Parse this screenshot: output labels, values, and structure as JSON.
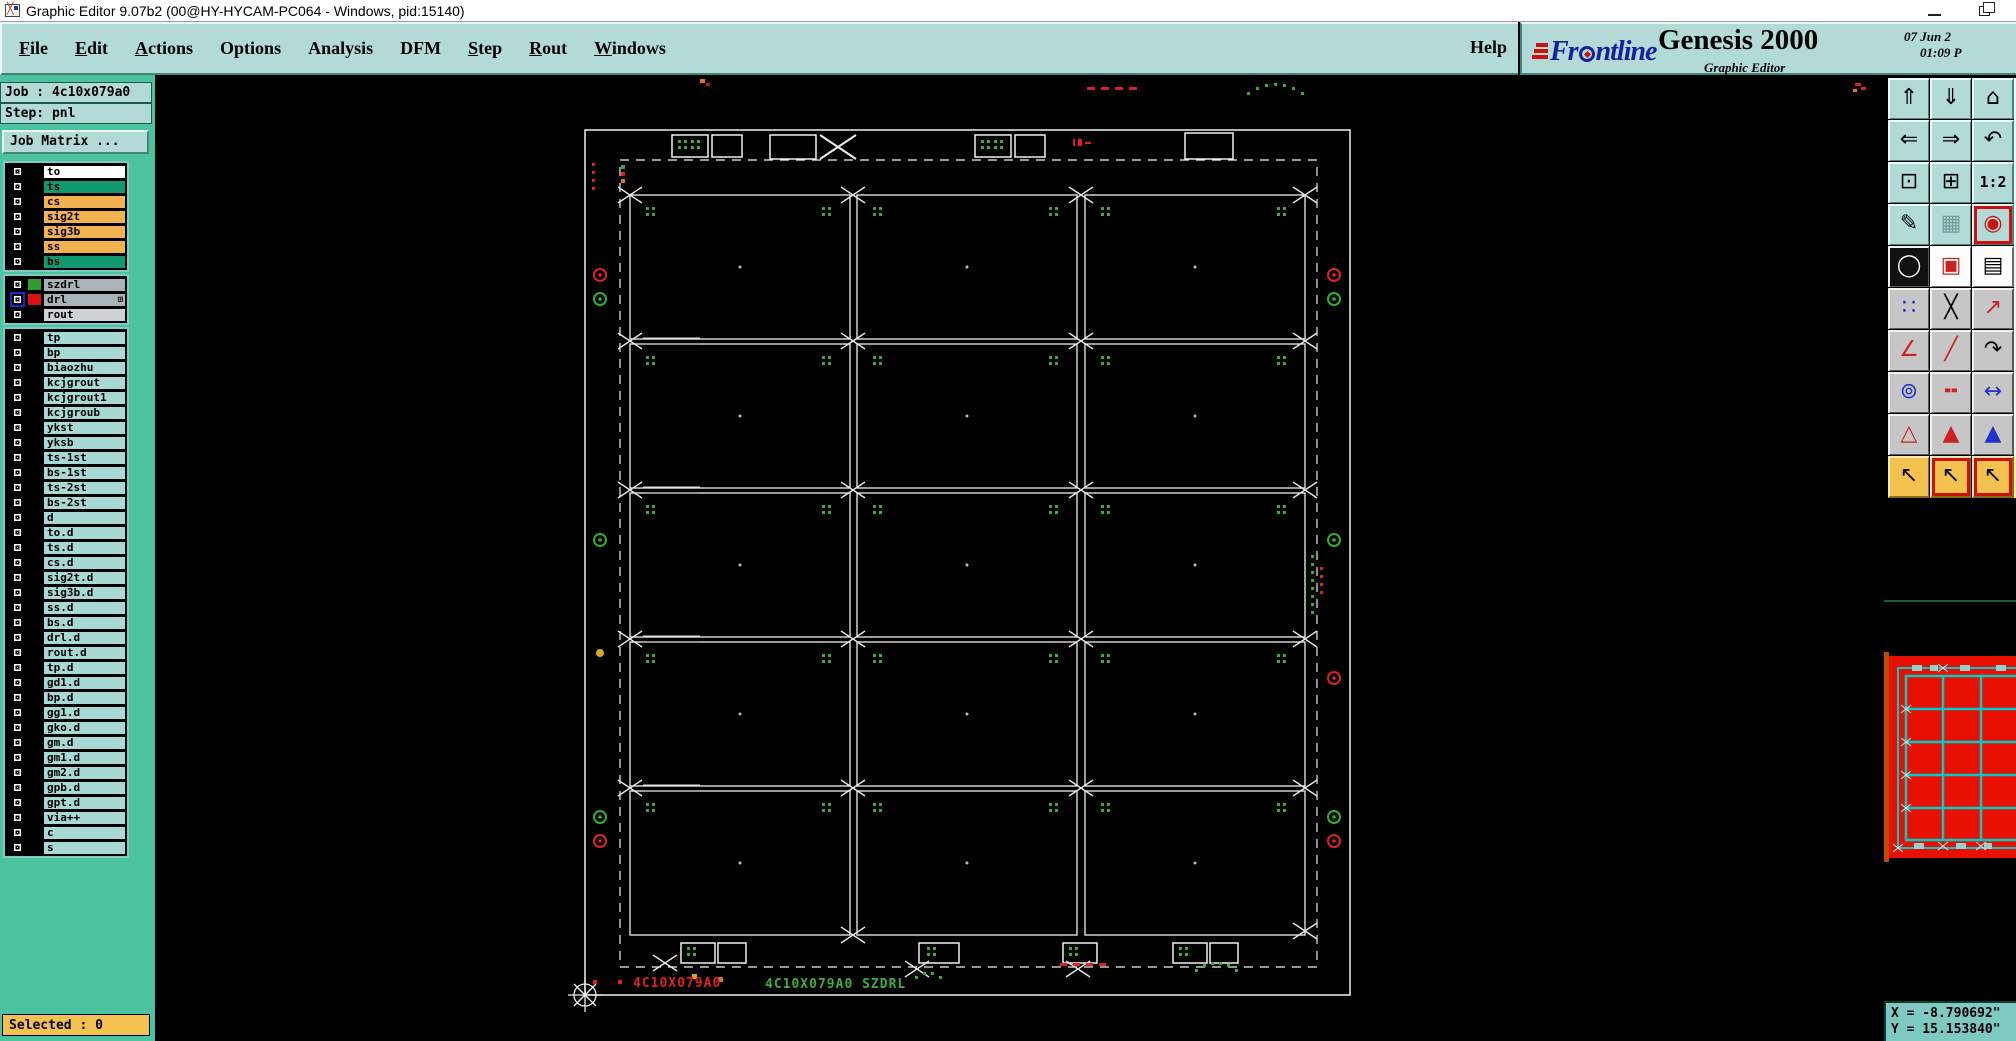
{
  "window": {
    "title": "Graphic Editor 9.07b2 (00@HY-HYCAM-PC064 - Windows, pid:15140)"
  },
  "menu": {
    "items": [
      {
        "name": "menu-file",
        "head": "F",
        "tail": "ile",
        "u": "u"
      },
      {
        "name": "menu-edit",
        "head": "E",
        "tail": "dit",
        "u": "u"
      },
      {
        "name": "menu-actions",
        "head": "A",
        "tail": "ctions",
        "u": "u"
      },
      {
        "name": "menu-options",
        "head": "O",
        "tail": "ptions"
      },
      {
        "name": "menu-analysis",
        "head": "A",
        "tail": "nalysis"
      },
      {
        "name": "menu-dfm",
        "head": "D",
        "tail": "FM"
      },
      {
        "name": "menu-step",
        "head": "S",
        "tail": "tep",
        "u": "u"
      },
      {
        "name": "menu-rout",
        "head": "R",
        "tail": "out",
        "u": "u"
      },
      {
        "name": "menu-windows",
        "head": "W",
        "tail": "indows",
        "u": "u"
      }
    ],
    "help_label": "Help"
  },
  "brand": {
    "company_prefix": "Fr",
    "company_suffix": "ntline",
    "product": "Genesis 2000",
    "app_subtitle": "Graphic Editor",
    "date": "07 Jun 2",
    "time": "01:09 P"
  },
  "sidebar": {
    "job_label": "Job : 4c10x079a0",
    "step_label": "Step: pnl",
    "matrix_button": "Job Matrix ...",
    "selected_label": "Selected : 0",
    "group1": [
      {
        "label": "to",
        "bg": "#ffffff"
      },
      {
        "label": "ts",
        "bg": "#12996f"
      },
      {
        "label": "cs",
        "bg": "#f2b24e"
      },
      {
        "label": "sig2t",
        "bg": "#f2b24e"
      },
      {
        "label": "sig3b",
        "bg": "#f2b24e"
      },
      {
        "label": "ss",
        "bg": "#f2b24e"
      },
      {
        "label": "bs",
        "bg": "#12996f"
      }
    ],
    "group2": [
      {
        "label": "szdrl",
        "bg": "#a9b4ba",
        "chip": "#2f9e2f"
      },
      {
        "label": "drl",
        "bg": "#a9b4ba",
        "chip": "#dd1111",
        "cls": "active",
        "suffix": "⊞"
      },
      {
        "label": "rout",
        "bg": "#ced2d5"
      }
    ],
    "group3": [
      {
        "label": "tp"
      },
      {
        "label": "bp"
      },
      {
        "label": "biaozhu"
      },
      {
        "label": "kcjgrout"
      },
      {
        "label": "kcjgrout1"
      },
      {
        "label": "kcjgroub"
      },
      {
        "label": "ykst"
      },
      {
        "label": "yksb"
      },
      {
        "label": "ts-1st"
      },
      {
        "label": "bs-1st"
      },
      {
        "label": "ts-2st"
      },
      {
        "label": "bs-2st"
      },
      {
        "label": "d"
      },
      {
        "label": "to.d"
      },
      {
        "label": "ts.d"
      },
      {
        "label": "cs.d"
      },
      {
        "label": "sig2t.d"
      },
      {
        "label": "sig3b.d"
      },
      {
        "label": "ss.d"
      },
      {
        "label": "bs.d"
      },
      {
        "label": "drl.d"
      },
      {
        "label": "rout.d"
      },
      {
        "label": "tp.d"
      },
      {
        "label": "gd1.d"
      },
      {
        "label": "bp.d"
      },
      {
        "label": "gg1.d"
      },
      {
        "label": "gko.d"
      },
      {
        "label": "gm.d"
      },
      {
        "label": "gm1.d"
      },
      {
        "label": "gm2.d"
      },
      {
        "label": "gpb.d"
      },
      {
        "label": "gpt.d"
      },
      {
        "label": "via++"
      },
      {
        "label": "c"
      },
      {
        "label": "s"
      }
    ]
  },
  "toolbar": {
    "buttons": [
      {
        "name": "view-up-button",
        "glyph": "⇑",
        "cls": "teal"
      },
      {
        "name": "view-down-button",
        "glyph": "⇓",
        "cls": "teal"
      },
      {
        "name": "home-view-button",
        "glyph": "⌂",
        "cls": "teal"
      },
      {
        "name": "view-left-button",
        "glyph": "⇐",
        "cls": "teal"
      },
      {
        "name": "view-right-button",
        "glyph": "⇒",
        "cls": "teal"
      },
      {
        "name": "previous-view-button",
        "glyph": "↶",
        "cls": "teal"
      },
      {
        "name": "zoom-fit-button",
        "glyph": "⊡",
        "cls": "teal"
      },
      {
        "name": "zoom-center-button",
        "glyph": "⊞",
        "cls": "teal"
      },
      {
        "name": "zoom-1-2-button",
        "glyph": "1:2",
        "cls": "teal txt"
      },
      {
        "name": "setup-editor-button",
        "glyph": "✎",
        "cls": "teal"
      },
      {
        "name": "grid-settings-button",
        "glyph": "▦",
        "cls": "teal",
        "fg": "#6f9e9a"
      },
      {
        "name": "targets-button",
        "glyph": "◉",
        "cls": "teal redframe",
        "fg": "#cc1111"
      },
      {
        "name": "layer-display-button",
        "glyph": "◯",
        "cls": "blackface",
        "fg": "#ffffff"
      },
      {
        "name": "shape-editor-button",
        "glyph": "▣",
        "cls": "whiteface",
        "fg": "#cc2222"
      },
      {
        "name": "measure-ruler-button",
        "glyph": "▤",
        "cls": "whiteface"
      },
      {
        "name": "net-highlight-button",
        "glyph": "∷",
        "cls": "gray",
        "fg": "#2233cc"
      },
      {
        "name": "unselect-button",
        "glyph": "╳",
        "cls": "gray"
      },
      {
        "name": "point-snap-button",
        "glyph": "↗",
        "cls": "gray",
        "fg": "#cc2222"
      },
      {
        "name": "angle-measure-button",
        "glyph": "∠",
        "cls": "gray",
        "fg": "#cc2222"
      },
      {
        "name": "distance-measure-button",
        "glyph": "╱",
        "cls": "gray",
        "fg": "#cc2222"
      },
      {
        "name": "rotate-view-button",
        "glyph": "↷",
        "cls": "gray"
      },
      {
        "name": "pad-copy-button",
        "glyph": "⊚",
        "cls": "gray",
        "fg": "#2233cc"
      },
      {
        "name": "line-width-button",
        "glyph": "╍",
        "cls": "gray",
        "fg": "#cc2222"
      },
      {
        "name": "width-measure-button",
        "glyph": "↔",
        "cls": "gray",
        "fg": "#2233cc"
      },
      {
        "name": "triangle-tool-button",
        "glyph": "△",
        "cls": "gray",
        "fg": "#cc2222"
      },
      {
        "name": "triangle-up-button",
        "glyph": "▲",
        "cls": "gray",
        "fg": "#cc2222"
      },
      {
        "name": "triangle-wide-button",
        "glyph": "▲",
        "cls": "gray",
        "fg": "#2233cc"
      },
      {
        "name": "select-mode-button",
        "glyph": "↖",
        "cls": "orange"
      },
      {
        "name": "select-frame-mode-button",
        "glyph": "↖",
        "cls": "orange redframe"
      },
      {
        "name": "select-poly-mode-button",
        "glyph": "↖",
        "cls": "orange redframe"
      }
    ]
  },
  "canvas": {
    "board_id_red": "4C10X079A0",
    "board_id_green": "4C10X079A0 SZDRL"
  },
  "status": {
    "x_coord": "X = -8.790692\"",
    "y_coord": "Y = 15.153840\""
  }
}
